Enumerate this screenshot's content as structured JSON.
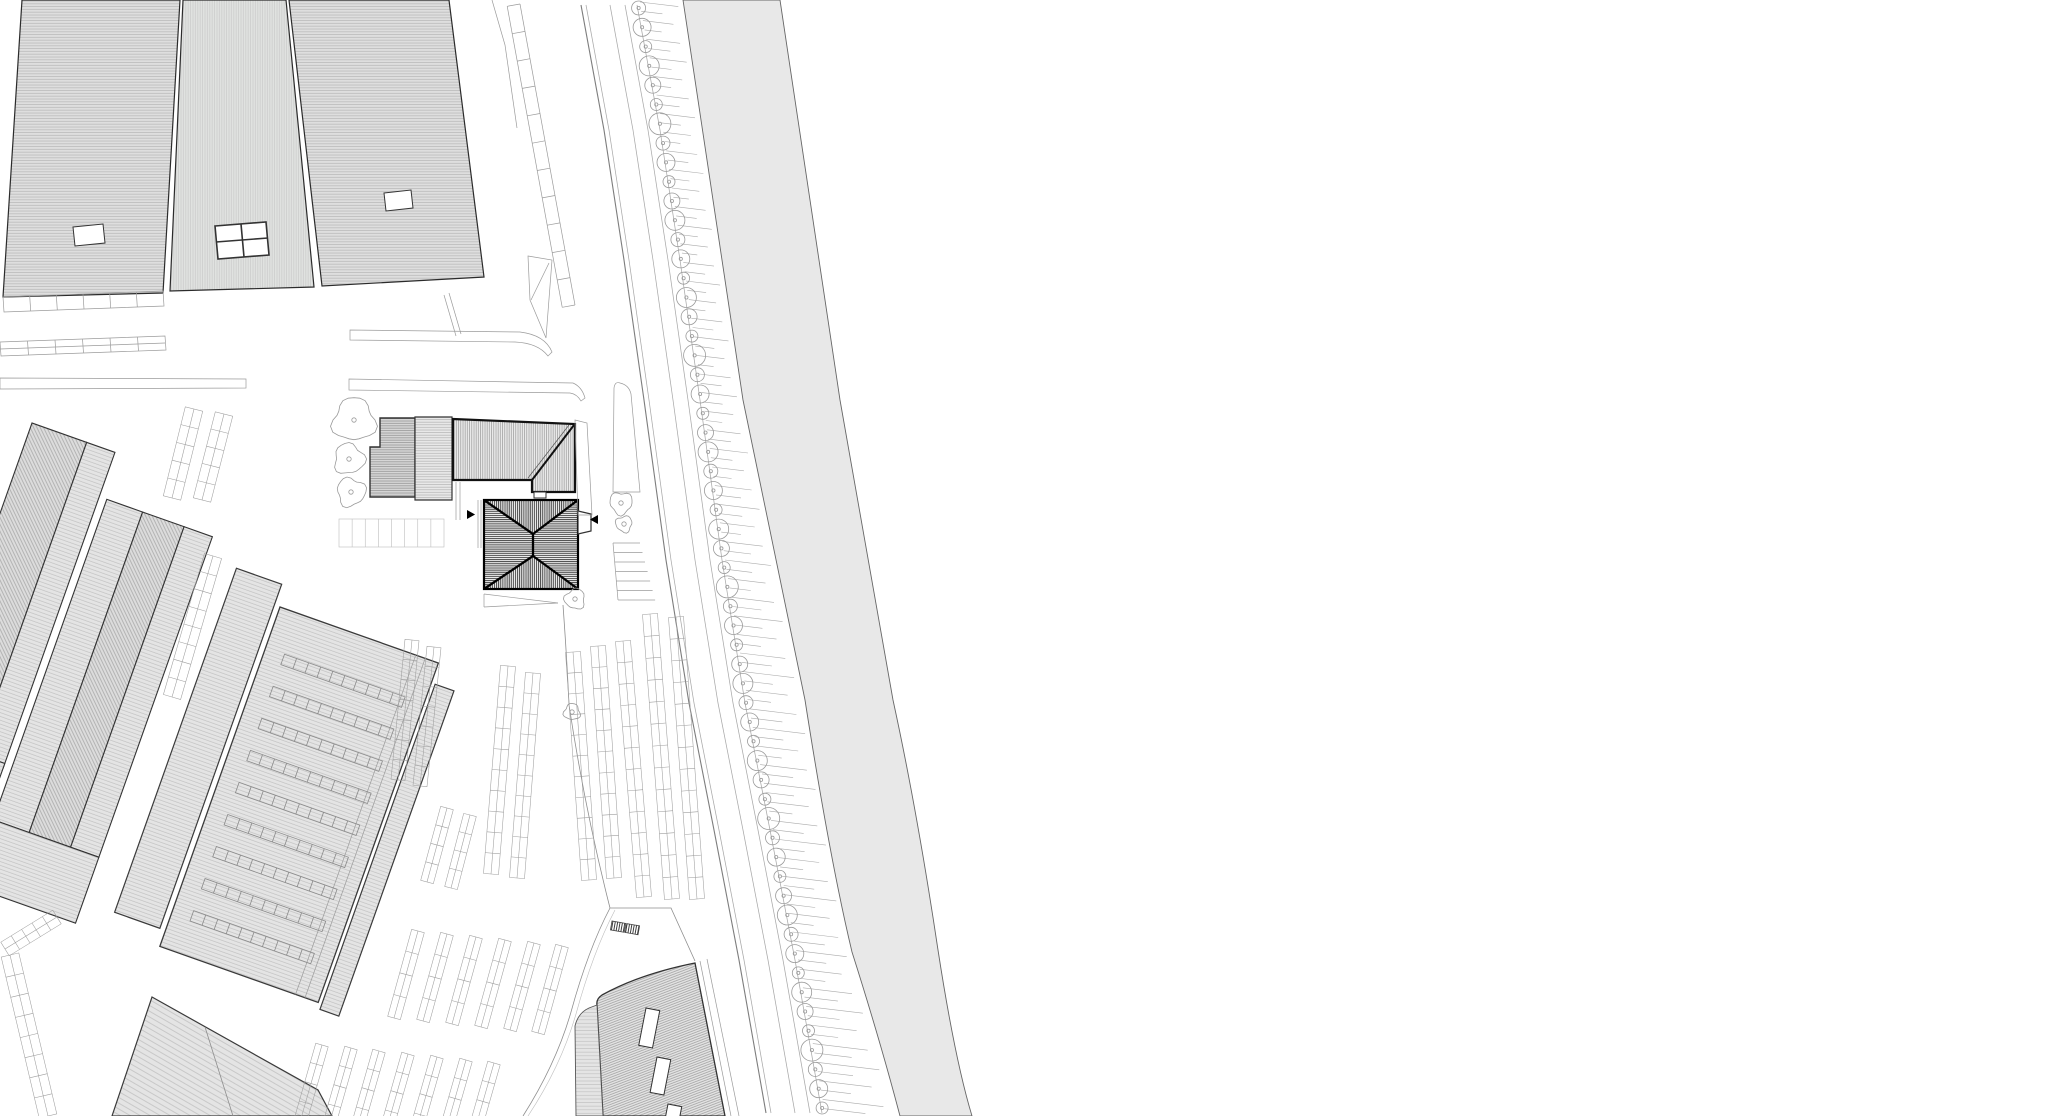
{
  "meta": {
    "title": "architectural-site-plan",
    "canvas": {
      "width": 2070,
      "height": 1116
    },
    "visible_text": "none"
  },
  "palette": {
    "background": "#ffffff",
    "roof_fill": "#dedede",
    "roof_fill_light": "#e6e6e6",
    "canal_fill": "#e8e8e8",
    "hatch_light": "#c4c4c4",
    "hatch_mid": "#9a9a9a",
    "hatch_dark": "#1a1a1a",
    "outline_dark": "#2b2b2b",
    "outline_heavy": "#111111",
    "line_gray": "#9b9b9b",
    "arrow_color": "#000000"
  },
  "avenue": {
    "tree_count": 58,
    "tree_line": [
      [
        637,
        5
      ],
      [
        660,
        130
      ],
      [
        680,
        260
      ],
      [
        700,
        400
      ],
      [
        722,
        560
      ],
      [
        745,
        703
      ],
      [
        770,
        830
      ],
      [
        795,
        960
      ],
      [
        822,
        1113
      ]
    ],
    "canal_left_edge": [
      [
        683,
        0
      ],
      [
        743,
        400
      ],
      [
        805,
        700
      ],
      [
        852,
        952
      ],
      [
        900,
        1116
      ]
    ],
    "tree_radii": [
      7,
      9,
      6,
      10,
      8,
      6,
      11,
      7,
      9,
      6,
      8,
      10
    ],
    "tick_step": 9.3,
    "tick_angle_drop": 0.12,
    "tick_length_factors": [
      1,
      0.55,
      0.8,
      0.45,
      0.9,
      0.6
    ],
    "road_line_offsets": [
      -56,
      -51,
      -27,
      -12,
      0
    ]
  },
  "ladder_stalls": {
    "x1": 520,
    "y1": 4,
    "x2": 575,
    "y2": 305,
    "width": 13,
    "rungs": 11
  },
  "stairs": {
    "x": 613,
    "y1": 543,
    "y2": 600,
    "steps": 6,
    "w1": 27,
    "w2": 37
  },
  "courtyard_grid": {
    "x": 339,
    "y": 519,
    "w": 105,
    "h": 28,
    "cells": 8
  },
  "divided_strips": [
    {
      "x1": 3,
      "y1": 297,
      "x2": 163,
      "y2": 291,
      "h": 15,
      "cells": 6,
      "mid": false
    },
    {
      "x1": 0,
      "y1": 342,
      "x2": 165,
      "y2": 336,
      "h": 14,
      "cells": 6,
      "mid": true
    }
  ],
  "section_arrows": [
    {
      "x": 467,
      "y": 510,
      "dir": 1,
      "size": 9
    },
    {
      "x": 598,
      "y": 515,
      "dir": -1,
      "size": 9
    }
  ],
  "site_trees": [
    {
      "cx": 354,
      "cy": 420,
      "r": 21
    },
    {
      "cx": 349,
      "cy": 459,
      "r": 15
    },
    {
      "cx": 351,
      "cy": 492,
      "r": 14
    },
    {
      "cx": 621,
      "cy": 503,
      "r": 11
    },
    {
      "cx": 624,
      "cy": 524,
      "r": 8
    },
    {
      "cx": 575,
      "cy": 599,
      "r": 10
    },
    {
      "cx": 572,
      "cy": 712,
      "r": 8
    }
  ],
  "skylight_rows": {
    "count": 9,
    "x": 300,
    "y0": 650,
    "dy": 34,
    "w": 128,
    "h": 11,
    "cells": 10
  },
  "parking_strips": [
    {
      "x1": 194,
      "y1": 409,
      "x2": 172,
      "y2": 498,
      "w": 18,
      "cells": 5
    },
    {
      "x1": 224,
      "y1": 414,
      "x2": 202,
      "y2": 500,
      "w": 18,
      "cells": 5
    },
    {
      "x1": 213,
      "y1": 556,
      "x2": 172,
      "y2": 697,
      "w": 18,
      "cells": 8
    },
    {
      "x1": 10,
      "y1": 955,
      "x2": 48,
      "y2": 1116,
      "w": 18,
      "cells": 8
    },
    {
      "x1": 57,
      "y1": 917,
      "x2": 5,
      "y2": 949,
      "w": 16,
      "cells": 5
    },
    {
      "x1": 447,
      "y1": 808,
      "x2": 427,
      "y2": 882,
      "w": 13,
      "cells": 4
    },
    {
      "x1": 470,
      "y1": 815,
      "x2": 451,
      "y2": 888,
      "w": 13,
      "cells": 4
    },
    {
      "x1": 508,
      "y1": 666,
      "x2": 491,
      "y2": 874,
      "w": 15,
      "cells": 10
    },
    {
      "x1": 533,
      "y1": 673,
      "x2": 517,
      "y2": 878,
      "w": 15,
      "cells": 10
    },
    {
      "x1": 412,
      "y1": 640,
      "x2": 398,
      "y2": 780,
      "w": 14,
      "cells": 7
    },
    {
      "x1": 434,
      "y1": 647,
      "x2": 420,
      "y2": 786,
      "w": 14,
      "cells": 7
    },
    {
      "x1": 573,
      "y1": 652,
      "x2": 589,
      "y2": 880,
      "w": 15,
      "cells": 11
    },
    {
      "x1": 598,
      "y1": 646,
      "x2": 614,
      "y2": 878,
      "w": 15,
      "cells": 11
    },
    {
      "x1": 623,
      "y1": 641,
      "x2": 644,
      "y2": 897,
      "w": 15,
      "cells": 12
    },
    {
      "x1": 650,
      "y1": 614,
      "x2": 672,
      "y2": 899,
      "w": 15,
      "cells": 13
    },
    {
      "x1": 676,
      "y1": 617,
      "x2": 697,
      "y2": 899,
      "w": 15,
      "cells": 13
    },
    {
      "x1": 418,
      "y1": 931,
      "x2": 394,
      "y2": 1018,
      "w": 13,
      "cells": 4
    },
    {
      "x1": 447,
      "y1": 934,
      "x2": 423,
      "y2": 1021,
      "w": 13,
      "cells": 4
    },
    {
      "x1": 476,
      "y1": 937,
      "x2": 452,
      "y2": 1024,
      "w": 13,
      "cells": 4
    },
    {
      "x1": 505,
      "y1": 940,
      "x2": 481,
      "y2": 1027,
      "w": 13,
      "cells": 4
    },
    {
      "x1": 534,
      "y1": 943,
      "x2": 510,
      "y2": 1030,
      "w": 13,
      "cells": 4
    },
    {
      "x1": 562,
      "y1": 946,
      "x2": 538,
      "y2": 1033,
      "w": 13,
      "cells": 4
    },
    {
      "x1": 322,
      "y1": 1045,
      "x2": 300,
      "y2": 1122,
      "w": 13,
      "cells": 4
    },
    {
      "x1": 351,
      "y1": 1048,
      "x2": 329,
      "y2": 1125,
      "w": 13,
      "cells": 4
    },
    {
      "x1": 379,
      "y1": 1051,
      "x2": 357,
      "y2": 1128,
      "w": 13,
      "cells": 4
    },
    {
      "x1": 408,
      "y1": 1054,
      "x2": 386,
      "y2": 1131,
      "w": 13,
      "cells": 4
    },
    {
      "x1": 437,
      "y1": 1057,
      "x2": 415,
      "y2": 1134,
      "w": 13,
      "cells": 4
    },
    {
      "x1": 466,
      "y1": 1060,
      "x2": 444,
      "y2": 1137,
      "w": 13,
      "cells": 4
    },
    {
      "x1": 494,
      "y1": 1063,
      "x2": 472,
      "y2": 1140,
      "w": 13,
      "cells": 4
    }
  ]
}
